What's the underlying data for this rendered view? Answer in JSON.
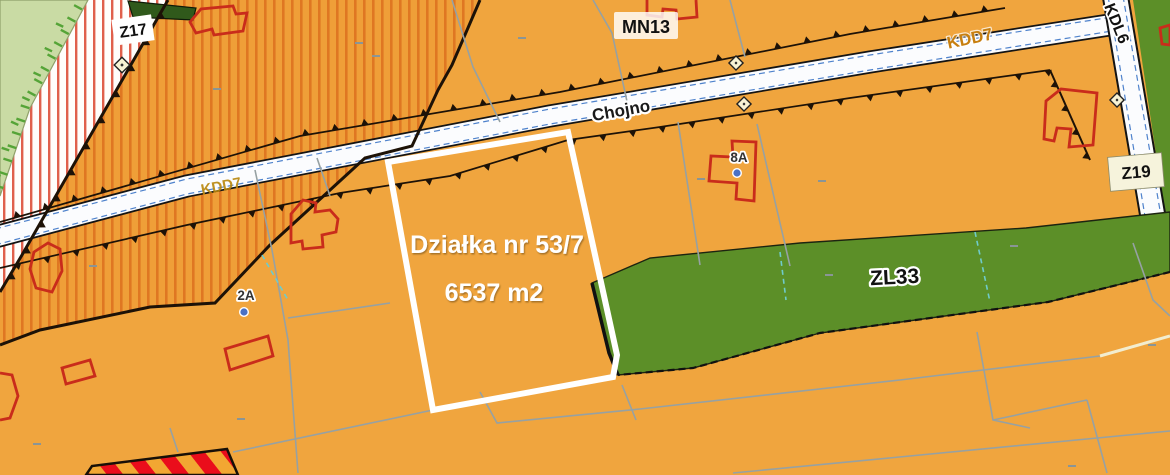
{
  "map": {
    "zones": {
      "z17": "Z17",
      "mn13": "MN13",
      "kdd7_top": "KDD7",
      "kdd7_left": "KDD7",
      "kdl6": "KDL6",
      "z19": "Z19",
      "zl33": "ZL33"
    },
    "street": {
      "name": "Chojno"
    },
    "parcel": {
      "title": "Działka nr 53/7",
      "area": "6537 m2"
    },
    "address_markers": {
      "m8a": "8A",
      "m2a": "2A"
    },
    "colors": {
      "zone_orange": "#F0A53E",
      "hatch_stripe": "#DF7722",
      "reserve_stripe_red": "#E0604C",
      "forest_green": "#5C8F28",
      "meadow_light_green": "#C9DBA4",
      "road_white": "#FBFCFE",
      "building_red": "#C92C1B",
      "parcel_highlight_white": "#FFFFFF",
      "planned_band_red": "#EA0D1B",
      "planned_band_yellow": "#F2A732",
      "marker_blue": "#4A71C4",
      "road_label_orange": "#C77F10",
      "parcel_line_gray": "#96A1A3",
      "teal_dashed": "#6FCBCB"
    }
  }
}
